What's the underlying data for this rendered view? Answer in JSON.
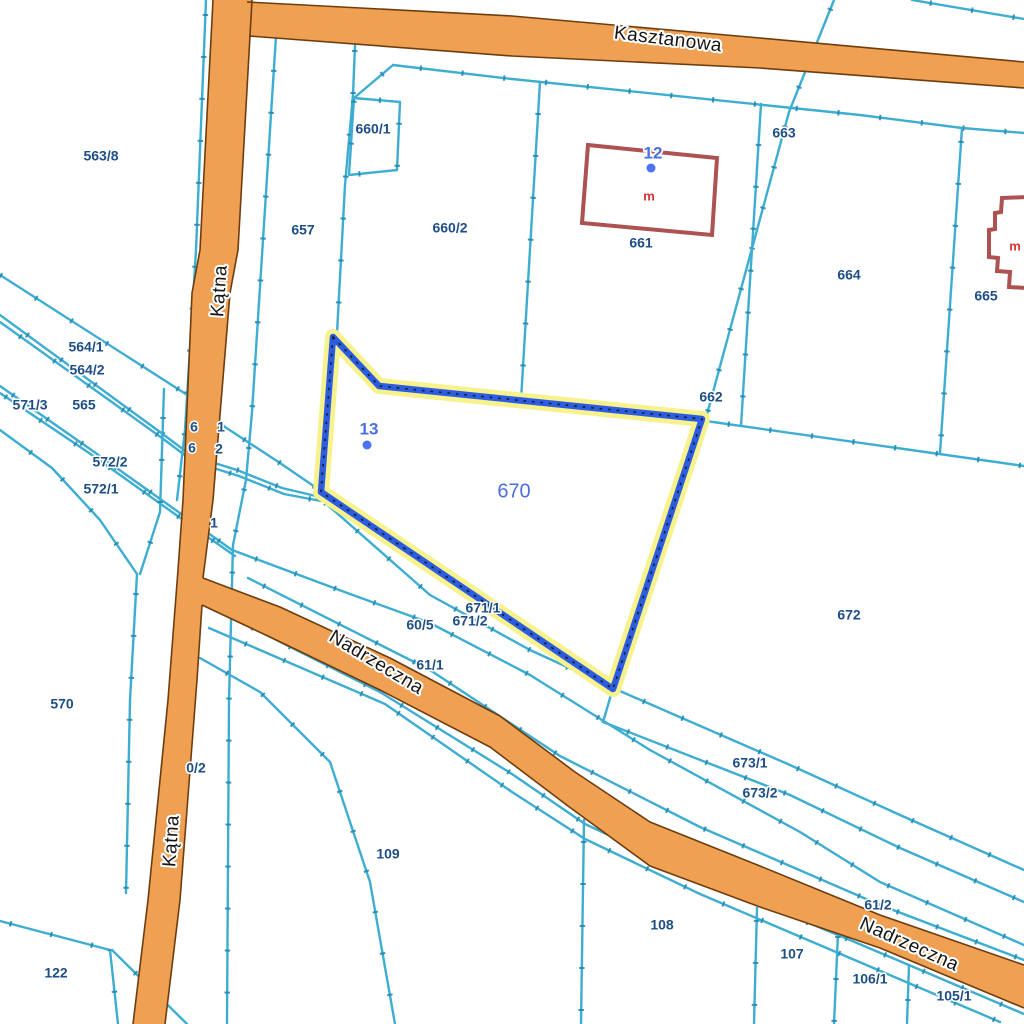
{
  "map": {
    "streets": [
      {
        "name": "Kasztanowa",
        "x": 668,
        "y": 40,
        "rotation": 7
      },
      {
        "name": "Kątna",
        "x": 220,
        "y": 291,
        "rotation": -86
      },
      {
        "name": "Kątna",
        "x": 172,
        "y": 841,
        "rotation": -86
      },
      {
        "name": "Nadrzeczna",
        "x": 376,
        "y": 663,
        "rotation": 31
      },
      {
        "name": "Nadrzeczna",
        "x": 909,
        "y": 945,
        "rotation": 24
      }
    ],
    "parcel_labels": [
      {
        "text": "563/8",
        "x": 101,
        "y": 157
      },
      {
        "text": "660/1",
        "x": 373,
        "y": 130
      },
      {
        "text": "657",
        "x": 303,
        "y": 231
      },
      {
        "text": "660/2",
        "x": 450,
        "y": 229
      },
      {
        "text": "663",
        "x": 784,
        "y": 134
      },
      {
        "text": "661",
        "x": 641,
        "y": 244
      },
      {
        "text": "664",
        "x": 849,
        "y": 276
      },
      {
        "text": "665",
        "x": 986,
        "y": 297
      },
      {
        "text": "564/1",
        "x": 86,
        "y": 348
      },
      {
        "text": "564/2",
        "x": 87,
        "y": 371
      },
      {
        "text": "571/3",
        "x": 30,
        "y": 406
      },
      {
        "text": "565",
        "x": 84,
        "y": 406
      },
      {
        "text": "572/2",
        "x": 110,
        "y": 463
      },
      {
        "text": "572/1",
        "x": 101,
        "y": 490
      },
      {
        "text": "662",
        "x": 711,
        "y": 398
      },
      {
        "text": "60/5",
        "x": 420,
        "y": 626
      },
      {
        "text": "61/1",
        "x": 430,
        "y": 666
      },
      {
        "text": "671/1",
        "x": 483,
        "y": 609
      },
      {
        "text": "671/2",
        "x": 470,
        "y": 622
      },
      {
        "text": "570",
        "x": 62,
        "y": 705
      },
      {
        "text": "109",
        "x": 388,
        "y": 855
      },
      {
        "text": "122",
        "x": 56,
        "y": 974
      },
      {
        "text": "672",
        "x": 849,
        "y": 616
      },
      {
        "text": "673/1",
        "x": 750,
        "y": 764
      },
      {
        "text": "673/2",
        "x": 760,
        "y": 794
      },
      {
        "text": "61/2",
        "x": 878,
        "y": 906
      },
      {
        "text": "108",
        "x": 662,
        "y": 926
      },
      {
        "text": "107",
        "x": 792,
        "y": 955
      },
      {
        "text": "106/1",
        "x": 870,
        "y": 980
      },
      {
        "text": "105/1",
        "x": 954,
        "y": 997
      }
    ],
    "partial_labels": [
      {
        "text": "6",
        "x": 194,
        "y": 428
      },
      {
        "text": "1",
        "x": 221,
        "y": 428
      },
      {
        "text": "6",
        "x": 192,
        "y": 449
      },
      {
        "text": "2",
        "x": 219,
        "y": 450
      },
      {
        "text": "1",
        "x": 214,
        "y": 524
      },
      {
        "text": "0/2",
        "x": 196,
        "y": 769
      }
    ],
    "highlighted_parcel": {
      "number": "670",
      "label_x": 514,
      "label_y": 492
    },
    "address_points": [
      {
        "label": "12",
        "label_x": 653,
        "label_y": 154,
        "dot_x": 651,
        "dot_y": 168
      },
      {
        "label": "13",
        "label_x": 369,
        "label_y": 430,
        "dot_x": 367,
        "dot_y": 445
      }
    ],
    "building_labels": [
      {
        "text": "m",
        "x": 649,
        "y": 197
      },
      {
        "text": "m",
        "x": 1015,
        "y": 247
      }
    ]
  },
  "colors": {
    "background": "#ffffff",
    "boundary_line": "#3dadd2",
    "boundary_tick": "#1d86ad",
    "road_fill": "#f0a052",
    "road_edge": "#6e3d0e",
    "highlight_halo": "#f7f28c",
    "highlight_line": "#2b5ce1",
    "highlight_dots": "#1a1a1a",
    "parcel_label": "#1e4e86",
    "point_label": "#4b6fe0",
    "point_dot": "#4d74f0",
    "building_outline": "#ad5151",
    "building_label": "#d93333",
    "street_label": "#151515"
  }
}
